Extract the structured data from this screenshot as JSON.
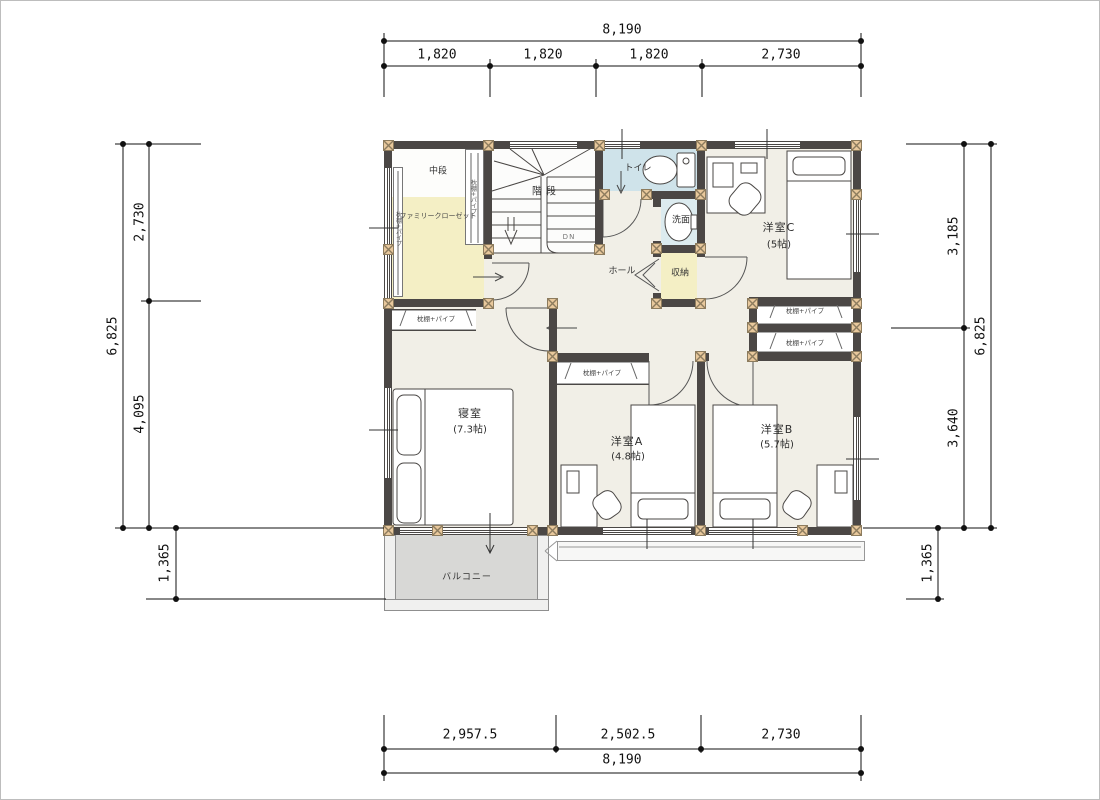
{
  "plan_title": "2F floor plan",
  "dims": {
    "top_total": "8,190",
    "top_segments": [
      "1,820",
      "1,820",
      "1,820",
      "2,730"
    ],
    "bottom_segments": [
      "2,957.5",
      "2,502.5",
      "2,730"
    ],
    "bottom_total": "8,190",
    "left_total": "6,825",
    "left_segments": [
      "2,730",
      "4,095"
    ],
    "left_lower": "1,365",
    "right_segments": [
      "3,185",
      "3,640"
    ],
    "right_total": "6,825",
    "right_lower": "1,365"
  },
  "rooms": {
    "nakadan": "中段",
    "family_closet": "ファミリークローゼット",
    "stairs": "階段",
    "stairs_dn": "DN",
    "toilet": "トイレ",
    "washroom": "洗面",
    "storage": "収納",
    "hall": "ホール",
    "western_c": "洋室C",
    "western_c_size": "(5帖)",
    "bedroom": "寝室",
    "bedroom_size": "(7.3帖)",
    "western_a": "洋室A",
    "western_a_size": "(4.8帖)",
    "western_b": "洋室B",
    "western_b_size": "(5.7帖)",
    "balcony": "バルコニー",
    "closet": "枕棚+パイプ"
  },
  "colors": {
    "wall": "#4b4745",
    "post": "#e8c89c",
    "floor": "#f1efe7",
    "toiletBlue": "#cfe3ea",
    "washBlue": "#dcebef",
    "closetYellow": "#f4efc5",
    "balcony": "#d8d8d6"
  }
}
